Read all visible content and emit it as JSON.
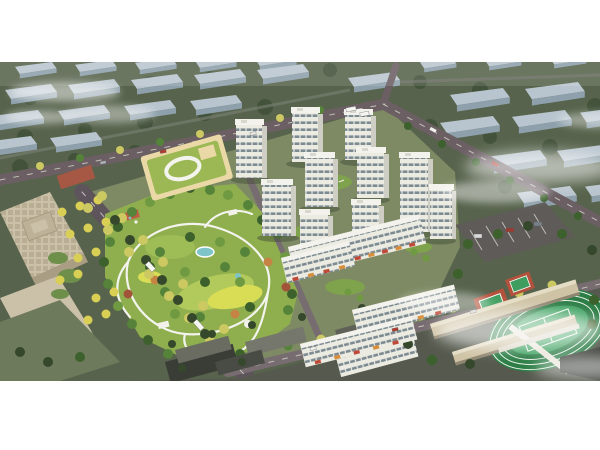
{
  "scene": {
    "type": "aerial-architectural-rendering",
    "time_of_day": "day",
    "regions": [
      "distant city blocks in fog",
      "central landscaped park with winding paths",
      "white residential tower cluster",
      "kindergarten with green roof and oval courtyard",
      "beige office buildings",
      "tree-lined boulevard",
      "school campus with running track and courts",
      "surface parking lot",
      "surrounding low urban fabric",
      "cloud wisps"
    ]
  },
  "palette": {
    "page_background": "#ffffff",
    "surrounding_ground": "#57634c",
    "distant_building_top": "#b9c5ce",
    "distant_building_side": "#8da0ab",
    "road_major": "#6b5f63",
    "road_boulevard": "#5e555c",
    "road_site": "#776c70",
    "site_ground": "#7e8a64",
    "park_grass": "#8fae4e",
    "park_grass_bright": "#b2ca5c",
    "lawn_yellow": "#d9dd55",
    "path_white": "#f4f4ee",
    "pond_teal": "#7fc4c9",
    "tower_face": "#ecebe2",
    "tower_side": "#cfcec5",
    "tower_window": "#7c8a91",
    "tower_roof": "#f3f2ec",
    "storefront_red": "#bf4a37",
    "kindergarten_roof": "#9cb854",
    "kindergarten_wall": "#ead9a6",
    "office_beige": "#cbc0a8",
    "office_facade": "#a99d83",
    "parking_asphalt": "#5f5b58",
    "sports_track_green": "#2c7d46",
    "sports_turf": "#3fa261",
    "court_red": "#b2523c",
    "school_roof": "#cfc3a5",
    "urban_ground": "#565a4e",
    "fog": "#ffffff"
  }
}
